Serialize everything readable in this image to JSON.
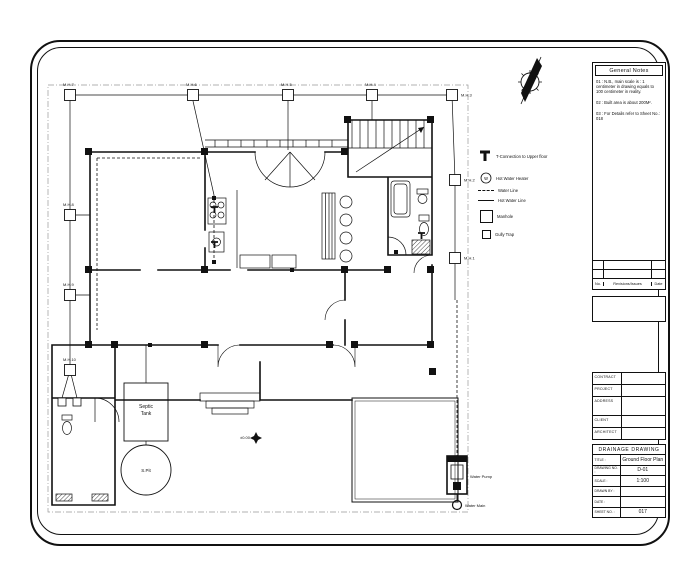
{
  "sheet_type": "architectural drainage drawing sheet",
  "legend": {
    "items": [
      {
        "icon": "t-connection-icon",
        "label": "T-Connection to Upper floor"
      },
      {
        "icon": "water-heater-icon",
        "label": "Hot Water Heater",
        "glyph": "w"
      },
      {
        "icon": "water-line-icon",
        "label": "Water Line"
      },
      {
        "icon": "hot-water-line-icon",
        "label": "Hot Water Line"
      },
      {
        "icon": "manhole-icon",
        "label": "Manhole"
      },
      {
        "icon": "gully-trap-icon",
        "label": "Gully Trap"
      }
    ]
  },
  "plan": {
    "manholes": [
      {
        "label": "M.H.7",
        "x": 70,
        "y": 95,
        "side": "top"
      },
      {
        "label": "M.H.6",
        "x": 193,
        "y": 95,
        "side": "top"
      },
      {
        "label": "M.H.5",
        "x": 288,
        "y": 95,
        "side": "top"
      },
      {
        "label": "M.H.4",
        "x": 372,
        "y": 95,
        "side": "top"
      },
      {
        "label": "M.H.3",
        "x": 452,
        "y": 95,
        "side": "right"
      },
      {
        "label": "M.H.2",
        "x": 455,
        "y": 180,
        "side": "right"
      },
      {
        "label": "M.H.1",
        "x": 455,
        "y": 258,
        "side": "right"
      },
      {
        "label": "M.H.8",
        "x": 70,
        "y": 215,
        "side": "top"
      },
      {
        "label": "M.H.9",
        "x": 70,
        "y": 295,
        "side": "top"
      },
      {
        "label": "M.H.10",
        "x": 70,
        "y": 370,
        "side": "top"
      }
    ],
    "gully_traps": [
      {
        "x": 62,
        "y": 402
      },
      {
        "x": 77,
        "y": 402
      }
    ],
    "septic_tank": {
      "line1": "Septic",
      "line2": "Tank"
    },
    "soak_pit": {
      "label": "S.Pit"
    },
    "water_pump": {
      "label": "Water Pump"
    },
    "water_main": {
      "label": "Water Main"
    },
    "level_marker": {
      "label": "±0.00"
    }
  },
  "notes_panel": {
    "title": "General Notes",
    "notes": [
      "01 : N.B., main scale is : 1 centimeter in drawing equals to 100 centimeter in reality.",
      "02 : Built area is about 200M².",
      "03 : For Details refer to Sheet No.: 018"
    ],
    "revisions": {
      "headers": [
        "No.",
        "Revisions/Issues",
        "Date"
      ],
      "rows": [
        [
          "",
          "",
          ""
        ],
        [
          "",
          "",
          ""
        ]
      ]
    }
  },
  "info_panel": {
    "rows": [
      {
        "label": "CONTRACT",
        "value": ""
      },
      {
        "label": "PROJECT",
        "value": ""
      },
      {
        "label": "ADDRESS",
        "value": ""
      },
      {
        "label": "CLIENT",
        "value": ""
      },
      {
        "label": "ARCHITECT",
        "value": ""
      }
    ]
  },
  "title_block": {
    "header": "DRAINAGE DRAWING",
    "rows": [
      {
        "label": "TITLE :",
        "value": "Ground Floor Plan"
      },
      {
        "label": "DRAWING NO. :",
        "value": "D-01"
      },
      {
        "label": "SCALE :",
        "value": "1:100"
      },
      {
        "label": "DRAWN BY :",
        "value": ""
      },
      {
        "label": "DATE :",
        "value": ""
      },
      {
        "label": "SHEET NO. :",
        "value": "017"
      }
    ]
  },
  "colors": {
    "line": "#111111",
    "paper": "#ffffff"
  }
}
